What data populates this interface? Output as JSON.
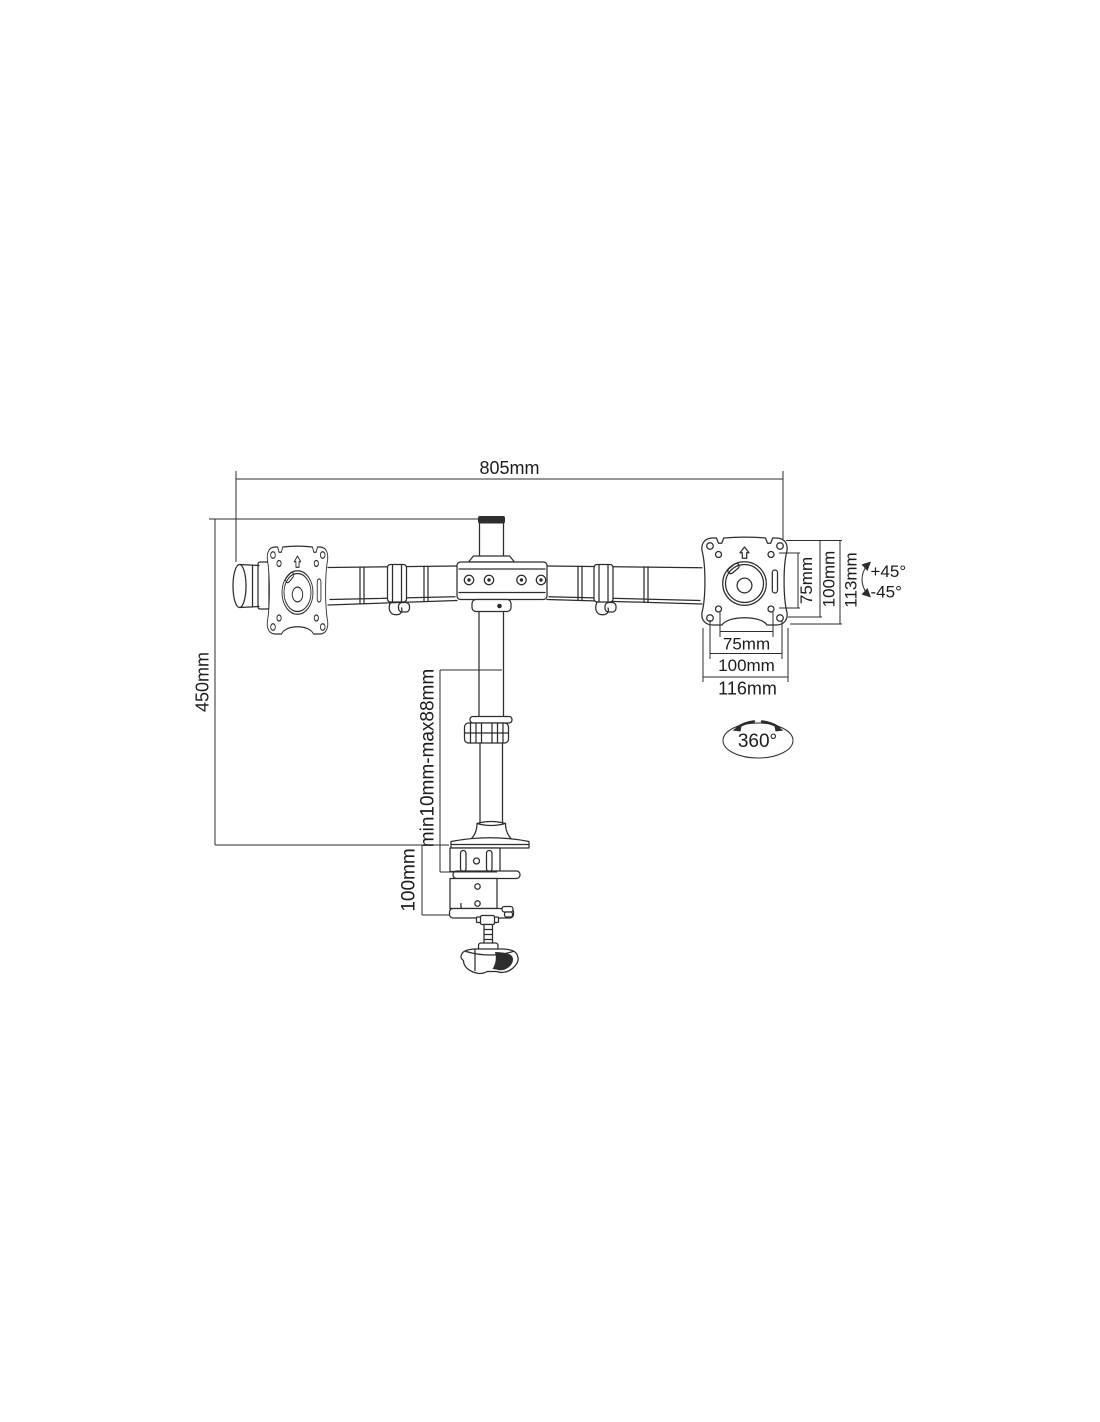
{
  "diagram": {
    "colors": {
      "ink": "#2d2d2d",
      "background": "#ffffff"
    },
    "dims": {
      "arm_width": "805mm",
      "pole_height": "450mm",
      "clamp_range": "min10mm-max88mm",
      "clamp_height": "100mm",
      "vesa_vertical_inner": "75mm",
      "vesa_vertical_outer": "100mm",
      "plate_height": "113mm",
      "tilt_up": "+45°",
      "tilt_down": "-45°",
      "vesa_horizontal_inner": "75mm",
      "vesa_horizontal_outer": "100mm",
      "plate_width": "116mm",
      "rotation": "360°"
    }
  }
}
